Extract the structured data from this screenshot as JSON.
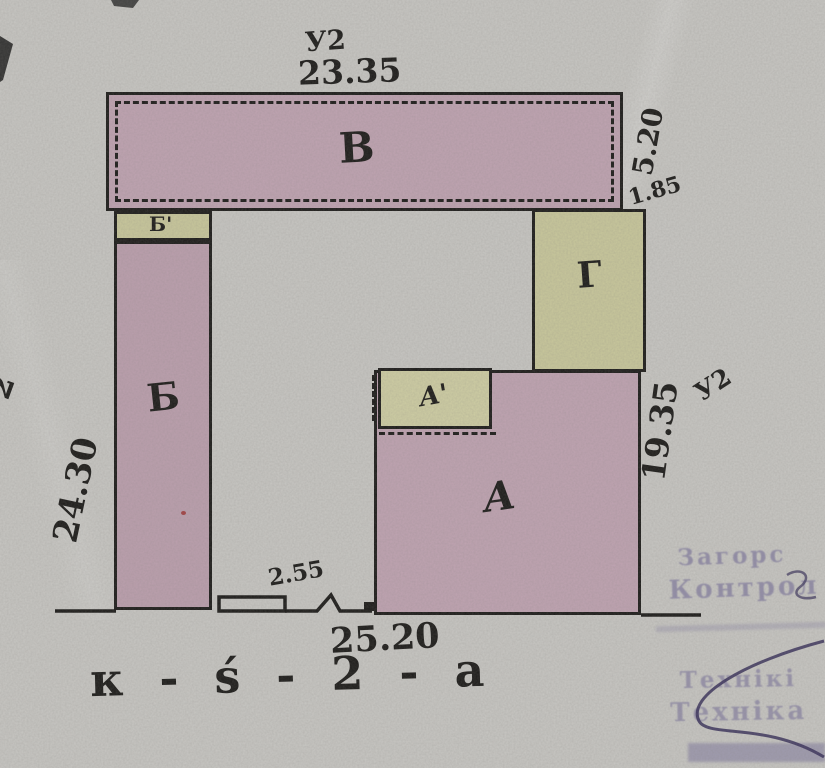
{
  "colors": {
    "paper": "#c8c7c3",
    "ink": "#1d1c1a",
    "pink": "#c0a4b2",
    "pink2": "#bca0ae",
    "yellow": "#c9c89c",
    "yellow2": "#cfcea4",
    "stamp": "#6b6394",
    "red": "#a03434"
  },
  "buildings": {
    "b": {
      "label": "В"
    },
    "b1": {
      "label": "Б'"
    },
    "b_col": {
      "label": "Б"
    },
    "g": {
      "label": "Г"
    },
    "a": {
      "label": "А"
    },
    "a1": {
      "label": "А'"
    }
  },
  "dimensions": {
    "top_marker": "У2",
    "top": "23.35",
    "right_b": "5.20",
    "right_offset": "1.85",
    "left": "24.30",
    "left_marker": "2",
    "right_a": "19.35",
    "right_marker": "У2",
    "gate": "2.55",
    "bottom": "25.20"
  },
  "caption": "к - ѕ́ - 2 - а",
  "stamps": {
    "control": {
      "line1": "Загорс",
      "line2": "Контрол"
    },
    "tech": {
      "line1": "Технікі",
      "line2": "Техніка"
    }
  }
}
